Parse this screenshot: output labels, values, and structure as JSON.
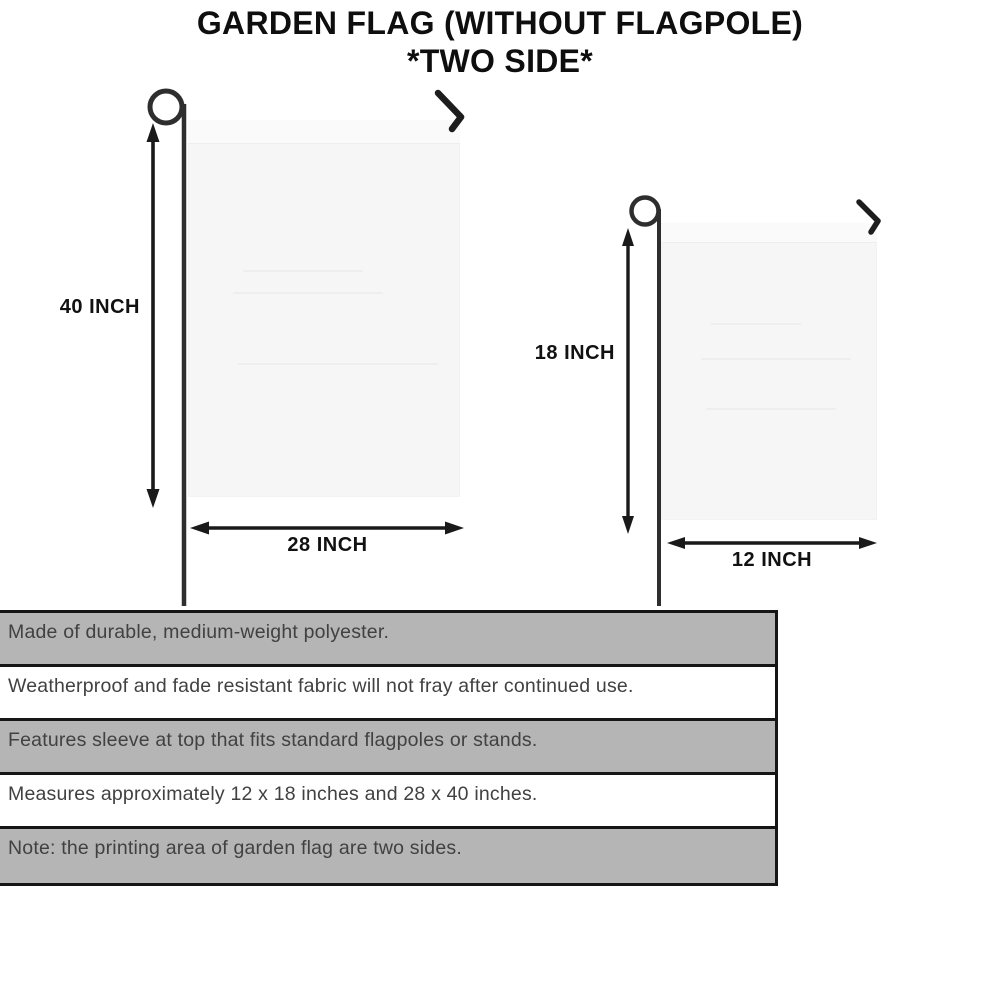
{
  "title": {
    "line1": "GARDEN FLAG (WITHOUT FLAGPOLE)",
    "line2": "*TWO SIDE*"
  },
  "diagram": {
    "large_flag": {
      "name": "large garden flag",
      "height_label": "40 INCH",
      "width_label": "28 INCH"
    },
    "small_flag": {
      "name": "small garden flag",
      "height_label": "18 INCH",
      "width_label": "12 INCH"
    }
  },
  "features": [
    "Made of durable, medium-weight polyester.",
    "Weatherproof and fade resistant fabric will not fray after continued use.",
    "Features sleeve at top that fits standard flagpoles or stands.",
    "Measures approximately 12 x 18 inches and 28 x 40 inches.",
    "Note: the printing area of garden flag are two sides."
  ],
  "colors": {
    "row_shaded": "#b5b5b5",
    "row_plain": "#ffffff",
    "table_border": "#161616",
    "flag_fill": "#f6f6f7",
    "pole": "#2e2e2e",
    "arrow": "#1a1a1a",
    "text": "#414141"
  }
}
